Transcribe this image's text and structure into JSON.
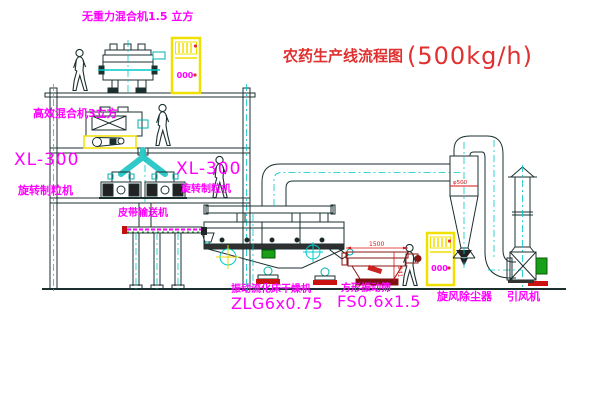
{
  "title": {
    "cn": "农药生产线流程图",
    "capacity": "(500kg/h)"
  },
  "labels": {
    "top_mixer": "无重力混合机1.5 立方",
    "mixer2": "高效混合机3立方",
    "granulator_model_1": "XL-300",
    "granulator_name_1": "旋转制粒机",
    "granulator_model_2": "XL-300",
    "granulator_name_2": "旋转制粒机",
    "conveyor": "皮带输送机",
    "dryer_name": "振动流化床干燥机",
    "dryer_model": "ZLG6x0.75",
    "sieve_name": "方形振动筛",
    "sieve_model": "FS0.6x1.5",
    "cyclone": "旋风除尘器",
    "fan": "引风机"
  },
  "annotations": {
    "cabinet1": "000",
    "cabinet2": "000",
    "dim_sieve_width": "1500",
    "dim_sieve_height": "941",
    "dim_cyclone": "φ500"
  },
  "colors": {
    "line": "#1b2f2f",
    "cyan": "#00c8c8",
    "magenta": "#ff00ff",
    "red": "#e03030",
    "yellow": "#f0e000",
    "green": "#18a018"
  }
}
